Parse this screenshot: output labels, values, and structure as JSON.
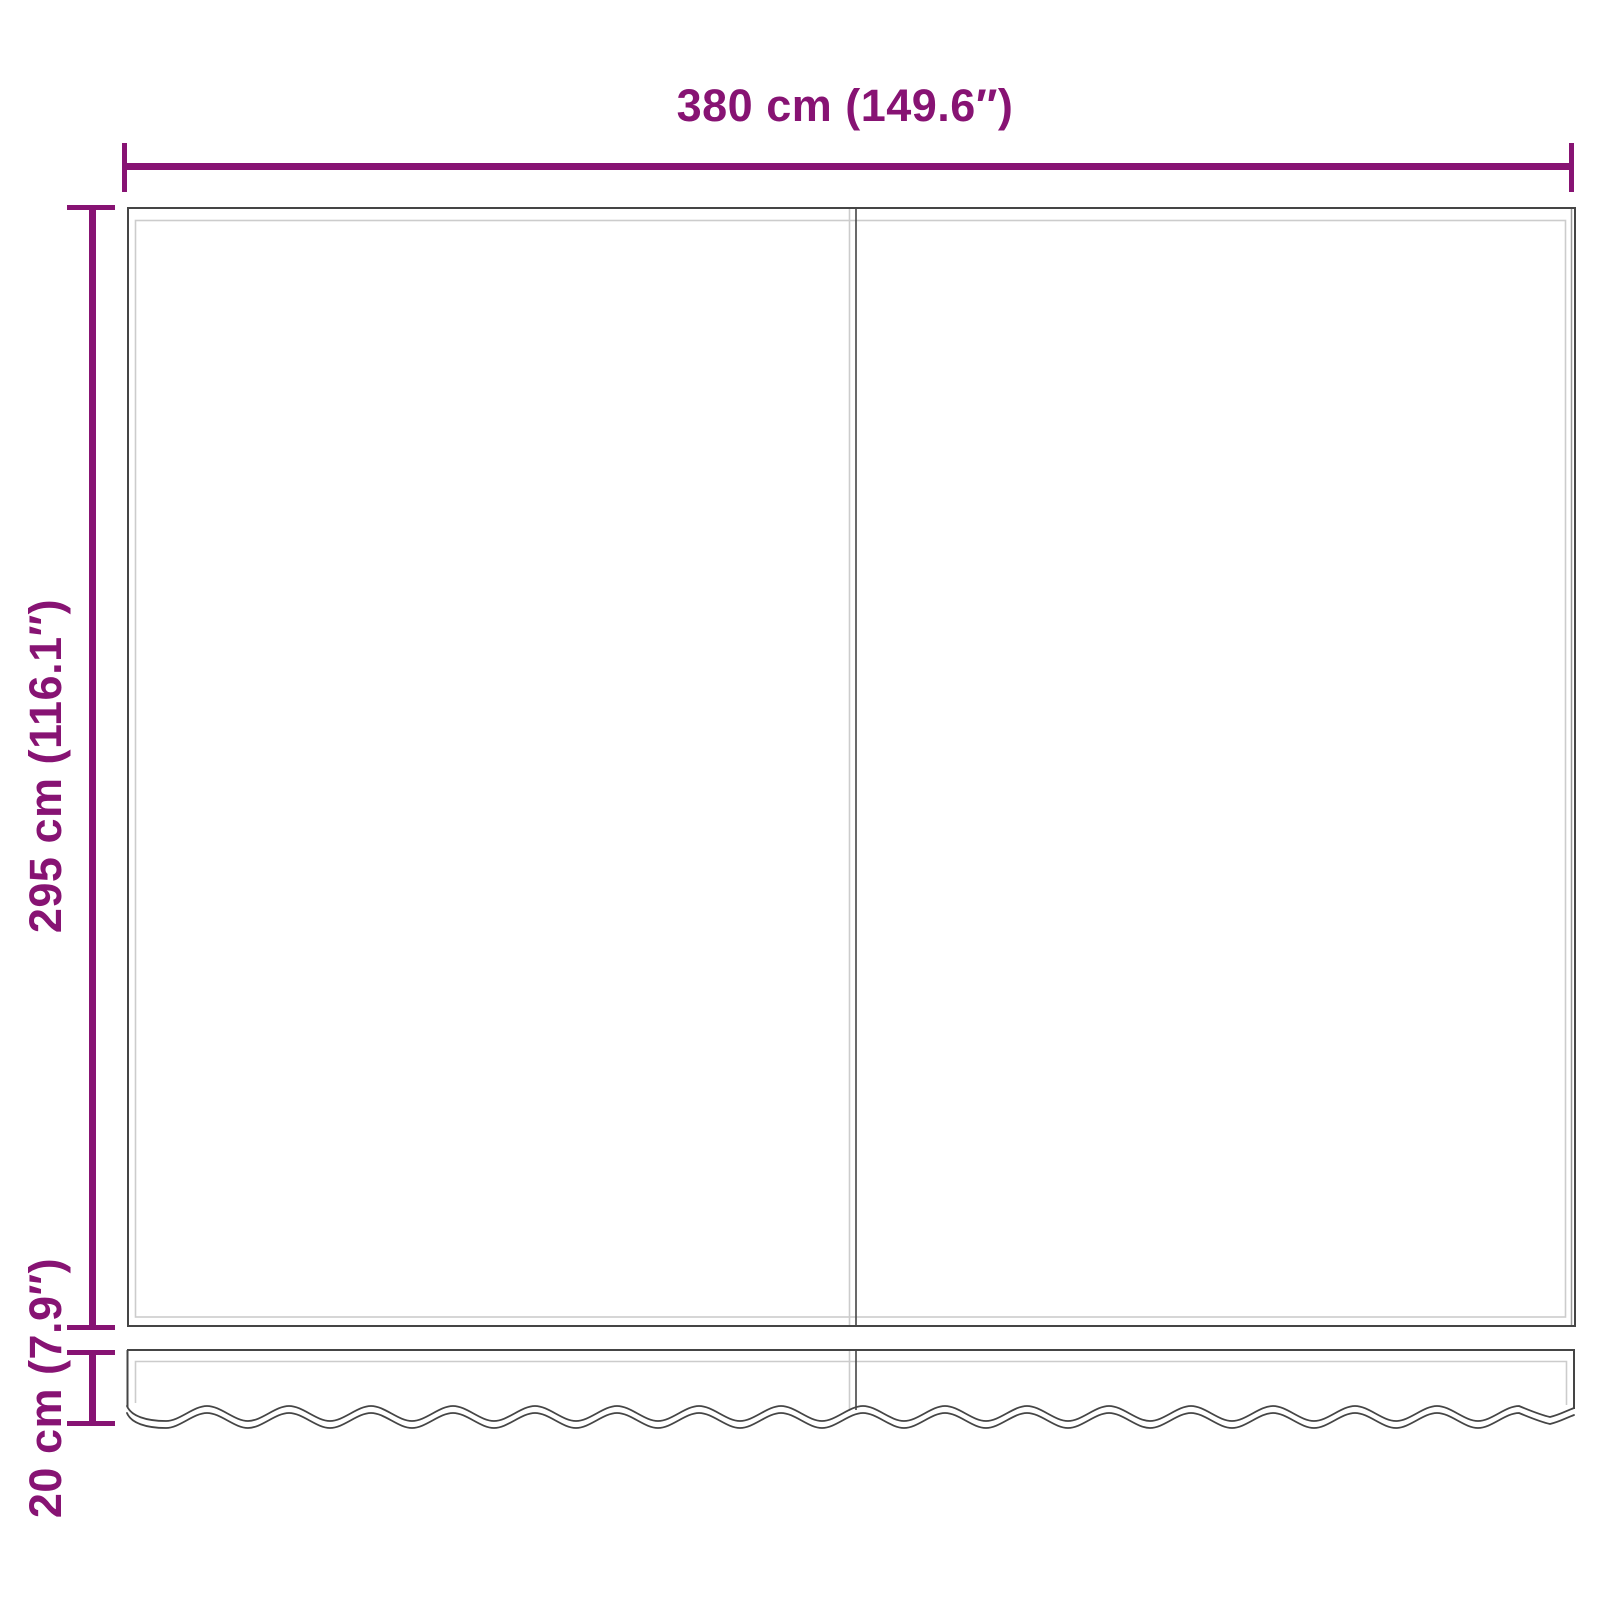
{
  "colors": {
    "accent": "#871373",
    "outline": "#454545",
    "soft": "#999999",
    "hem": "#cccccc",
    "bg": "#ffffff"
  },
  "diagram": {
    "type": "product-dimension-diagram",
    "subject": "awning-replacement-fabric-with-valance",
    "dimensions": {
      "width": {
        "label": "380 cm (149.6″)",
        "cm": 380,
        "inches": 149.6
      },
      "height": {
        "label": "295 cm (116.1″)",
        "cm": 295,
        "inches": 116.1
      },
      "valance": {
        "label": "20 cm (7.9″)",
        "cm": 20,
        "inches": 7.9
      }
    }
  }
}
